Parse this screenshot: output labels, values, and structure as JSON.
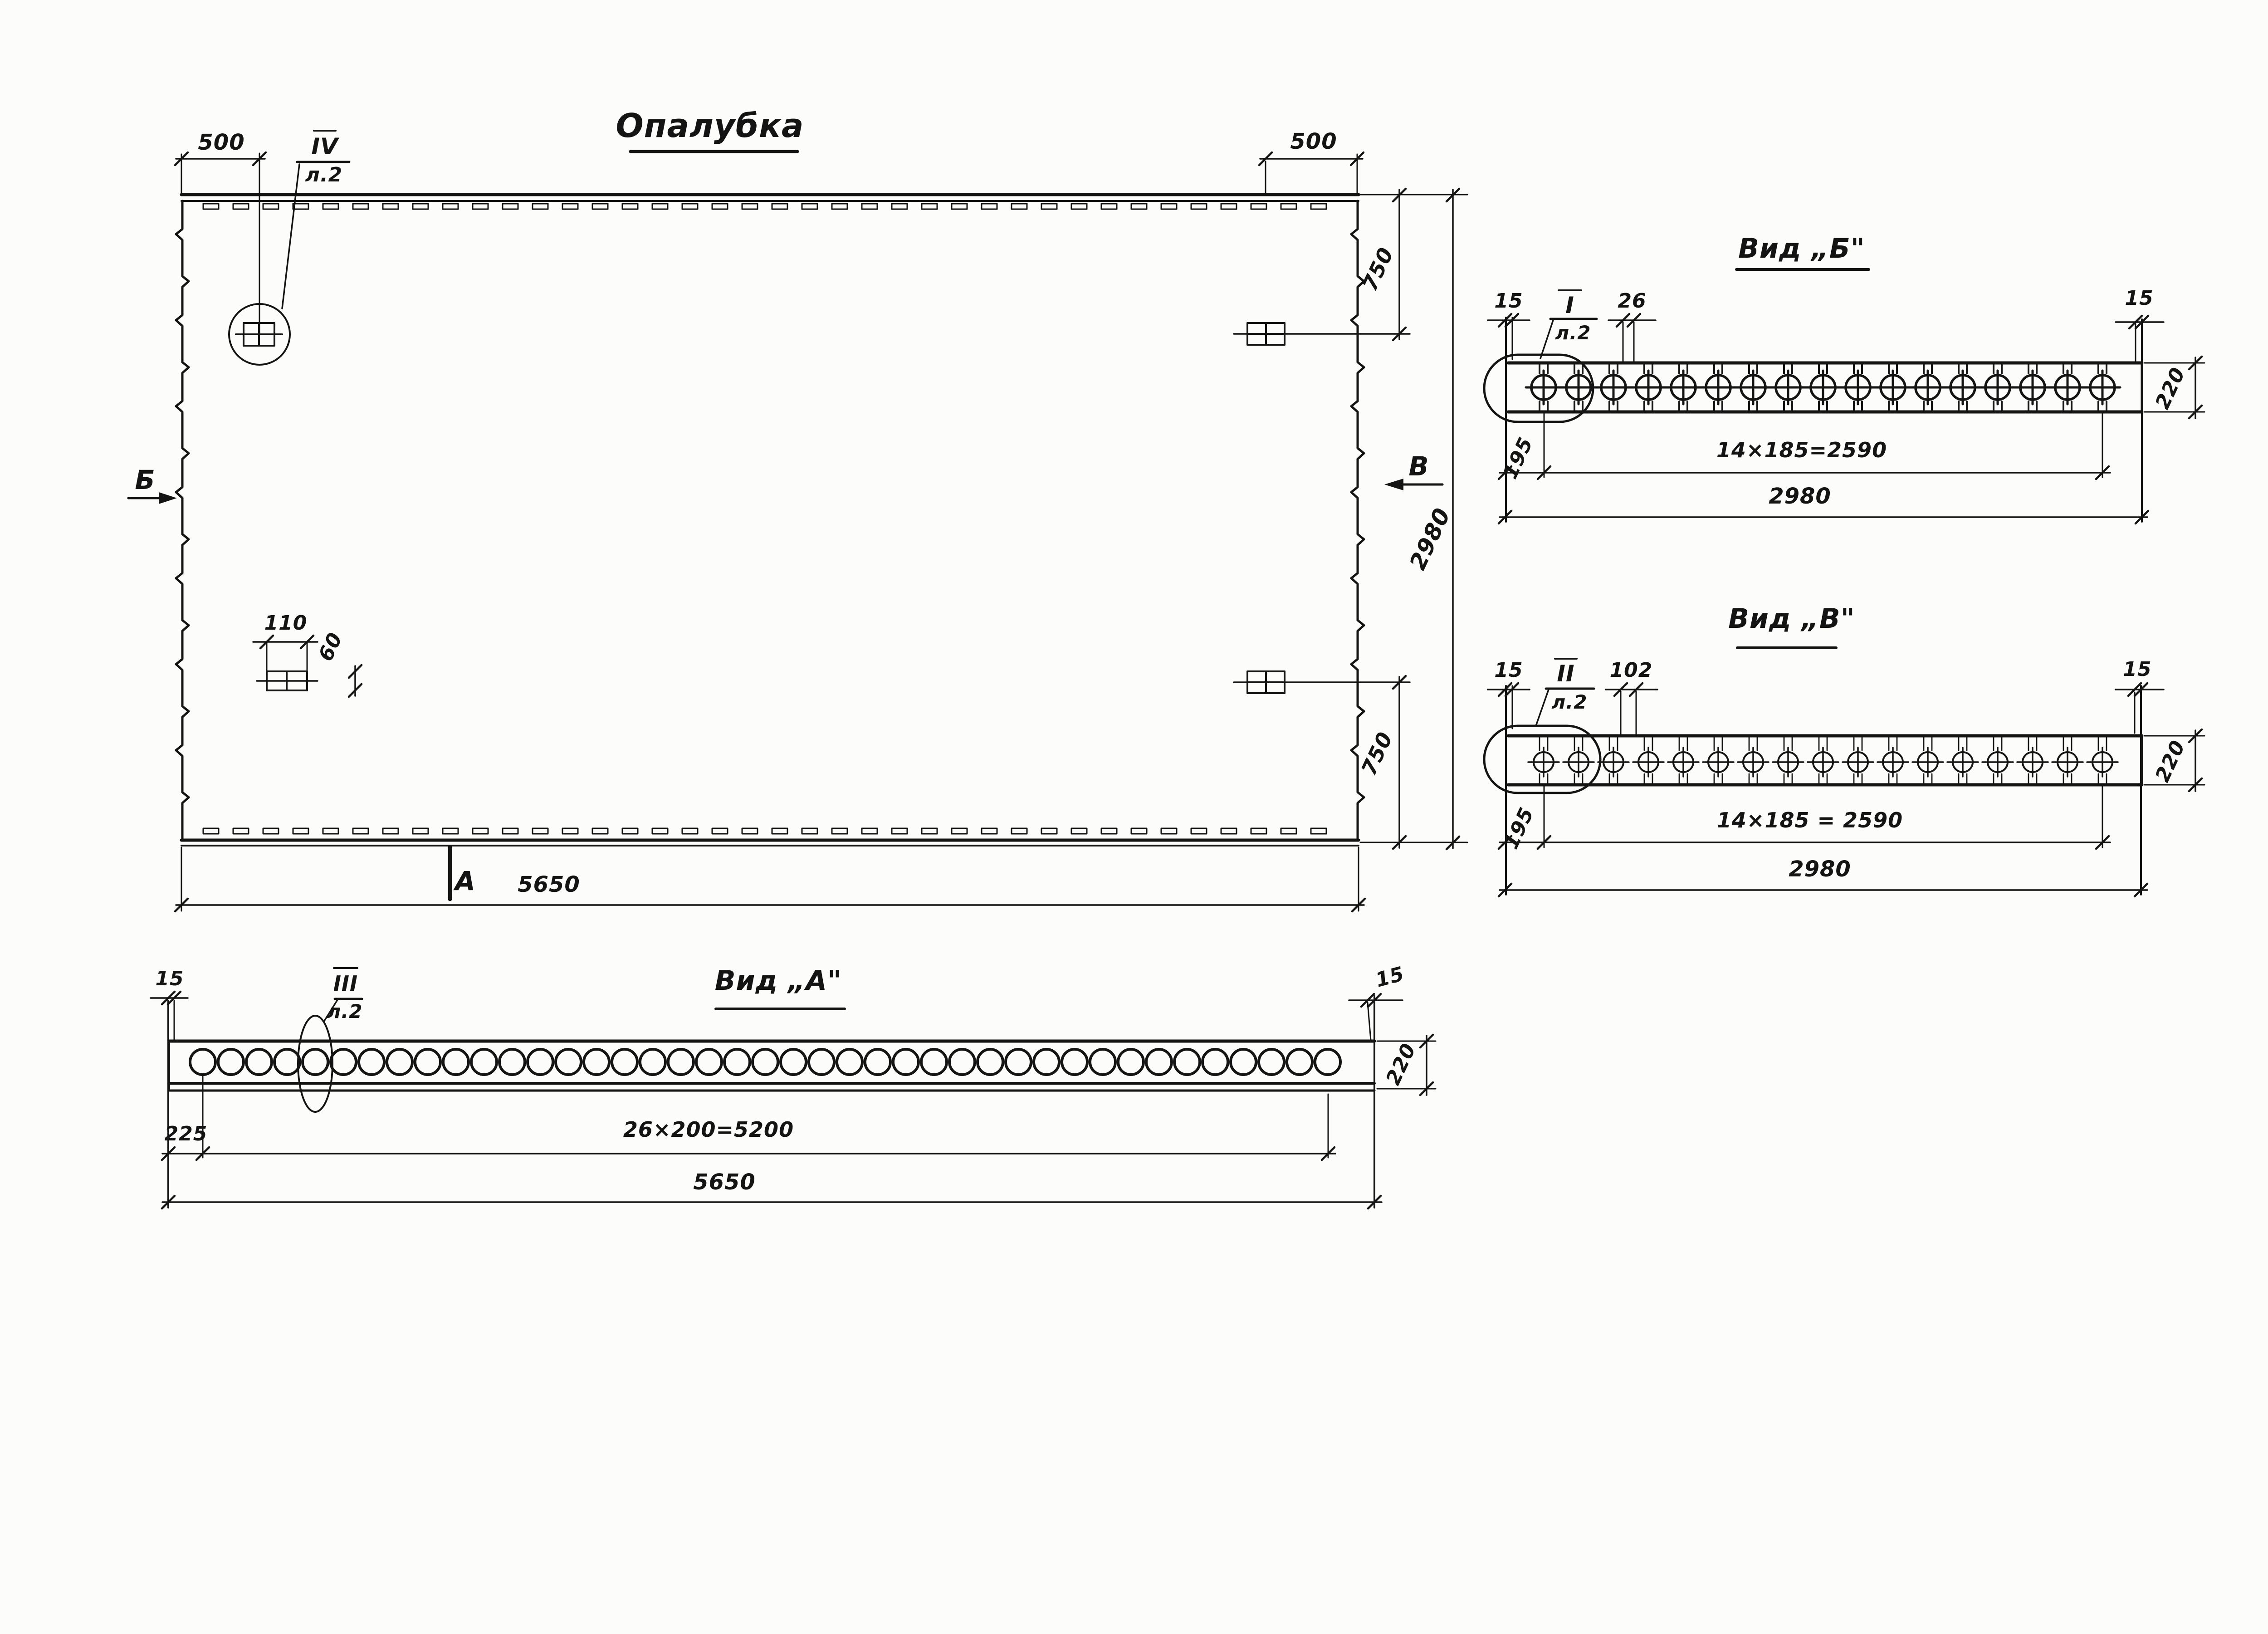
{
  "title": {
    "text": "Опалубка"
  },
  "plan": {
    "dim_top_left": "500",
    "dim_top_right": "500",
    "dim_right_upper": "750",
    "dim_right_lower": "750",
    "dim_right_overall": "2980",
    "dim_bottom_overall": "5650",
    "detail_dim_width": "110",
    "detail_dim_height": "60",
    "marker_left": "Б",
    "marker_right": "В",
    "marker_bottom": "А",
    "callout_label": "IV",
    "callout_sheet": "л.2"
  },
  "view_b": {
    "title": "Вид „Б\"",
    "callout_label": "I",
    "callout_sheet": "л.2",
    "dim_edge_left": "15",
    "dim_rib": "26",
    "dim_edge_right": "15",
    "dim_height": "220",
    "dim_first": "195",
    "dim_pitch": "14×185=2590",
    "dim_overall": "2980",
    "bolt_count": 17
  },
  "view_v": {
    "title": "Вид „В\"",
    "callout_label": "II",
    "callout_sheet": "л.2",
    "dim_edge_left": "15",
    "dim_rib": "102",
    "dim_edge_right": "15",
    "dim_height": "220",
    "dim_first": "195",
    "dim_pitch": "14×185 = 2590",
    "dim_overall": "2980",
    "bolt_count": 17
  },
  "view_a": {
    "title": "Вид „А\"",
    "callout_label": "III",
    "callout_sheet": "л.2",
    "dim_edge_left": "15",
    "dim_edge_right": "15",
    "dim_height": "220",
    "dim_first": "225",
    "dim_pitch": "26×200=5200",
    "dim_overall": "5650",
    "hole_count": 41
  }
}
